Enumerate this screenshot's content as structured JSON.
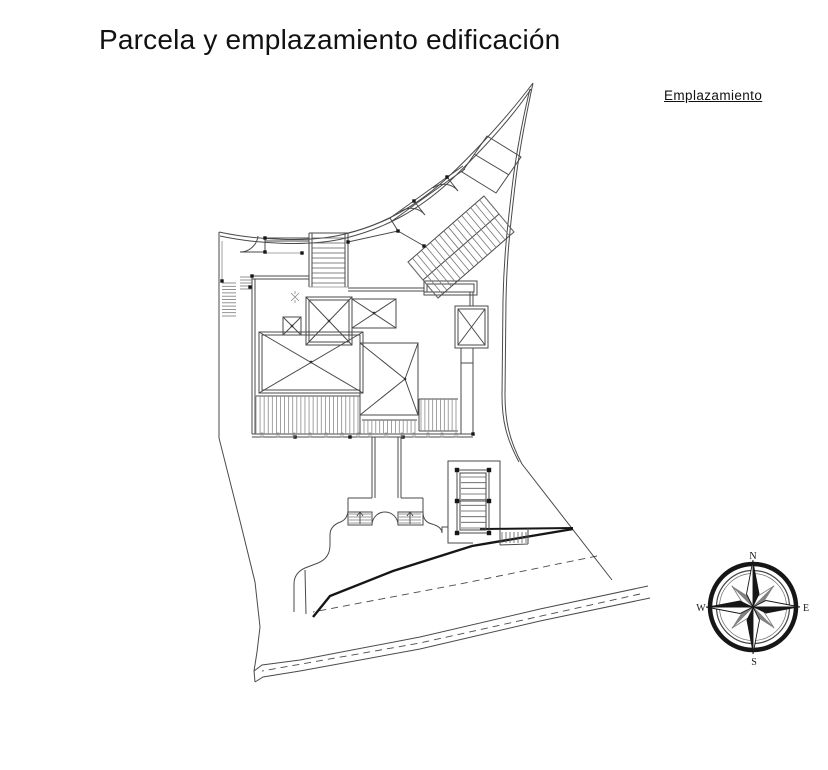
{
  "page": {
    "title": "Parcela y emplazamiento edificación"
  },
  "plan": {
    "label": "Emplazamiento"
  },
  "compass": {
    "north": "N",
    "east": "E",
    "south": "S",
    "west": "W"
  },
  "colors": {
    "background": "#ffffff",
    "line": "#4a4a4a",
    "line_light": "#8a8a8a",
    "line_dark": "#161616",
    "text": "#111111"
  }
}
